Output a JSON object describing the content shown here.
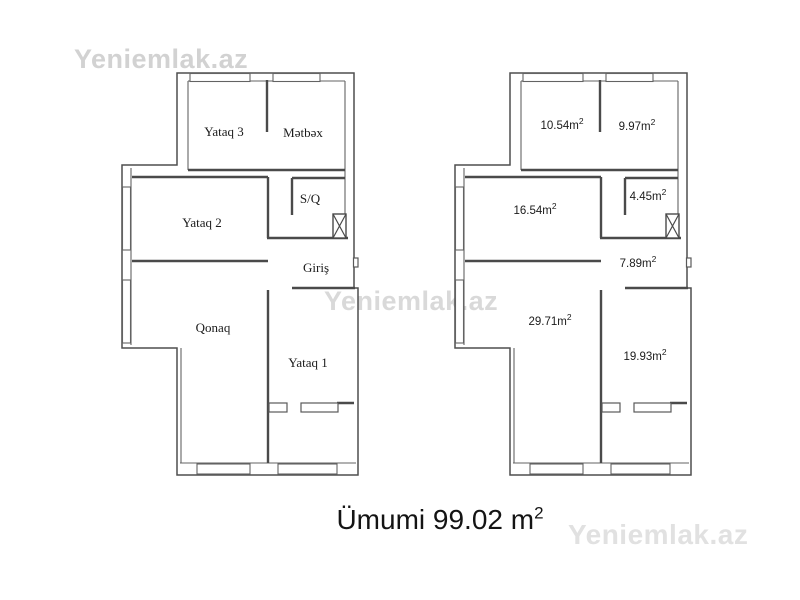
{
  "watermarks": {
    "top_left": "Yeniemlak.az",
    "center": "Yeniemlak.az",
    "bottom_right": "Yeniemlak.az",
    "color": "#d6d6d6"
  },
  "plans": [
    {
      "id": "left-plan-room-names",
      "rooms": [
        {
          "name": "yataq-3",
          "label": "Yataq 3"
        },
        {
          "name": "metbex",
          "label": "Mətbəx"
        },
        {
          "name": "yataq-2",
          "label": "Yataq 2"
        },
        {
          "name": "s-q",
          "label": "S/Q"
        },
        {
          "name": "giris",
          "label": "Giriş"
        },
        {
          "name": "qonaq",
          "label": "Qonaq"
        },
        {
          "name": "yataq-1",
          "label": "Yataq 1"
        }
      ]
    },
    {
      "id": "right-plan-areas",
      "rooms": [
        {
          "name": "yataq-3",
          "label": "10.54m",
          "sup": "2"
        },
        {
          "name": "metbex",
          "label": "9.97m",
          "sup": "2"
        },
        {
          "name": "yataq-2",
          "label": "16.54m",
          "sup": "2"
        },
        {
          "name": "s-q",
          "label": "4.45m",
          "sup": "2"
        },
        {
          "name": "giris",
          "label": "7.89m",
          "sup": "2"
        },
        {
          "name": "qonaq",
          "label": "29.71m",
          "sup": "2"
        },
        {
          "name": "yataq-1",
          "label": "19.93m",
          "sup": "2"
        }
      ]
    }
  ],
  "total": {
    "text": "Ümumi 99.02 m",
    "sup": "2",
    "value": "99.02"
  },
  "colors": {
    "wall": "#4a4a4a",
    "text": "#1b1b1b",
    "watermark": "#d6d6d6",
    "background": "#ffffff"
  }
}
